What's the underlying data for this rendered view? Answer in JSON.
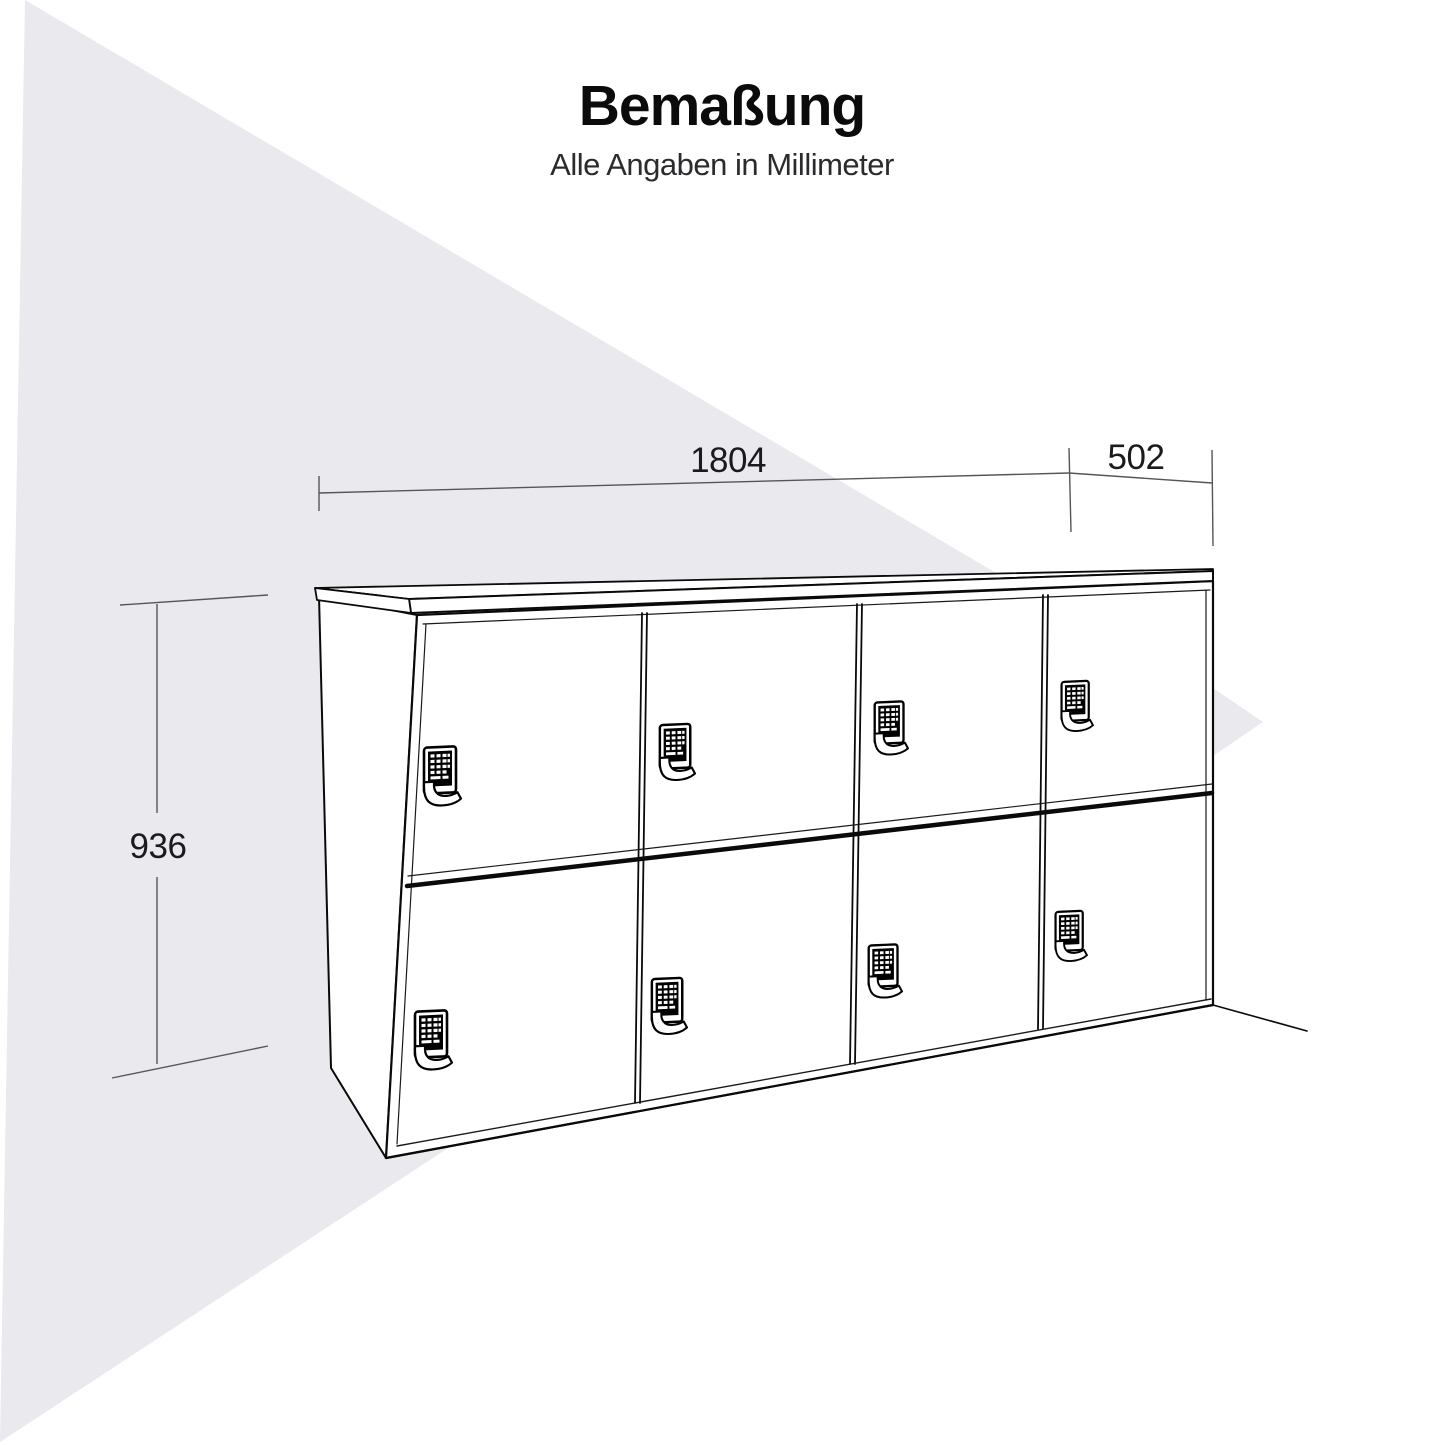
{
  "header": {
    "title": "Bemaßung",
    "subtitle": "Alle Angaben in Millimeter"
  },
  "dimensions": {
    "width_mm": "1804",
    "depth_mm": "502",
    "height_mm": "936",
    "unit": "Millimeter"
  },
  "cabinet": {
    "type": "locker-sideboard",
    "door_rows": 2,
    "door_columns": 4,
    "door_count": 8,
    "lock_icon": "keypad-lock-icon"
  },
  "colors": {
    "background": "#ffffff",
    "shape_gray": "#e9e9ee",
    "outline_black": "#0a0a0a",
    "dim_line_gray": "#55565a",
    "text_dark": "#1b1b1e"
  }
}
